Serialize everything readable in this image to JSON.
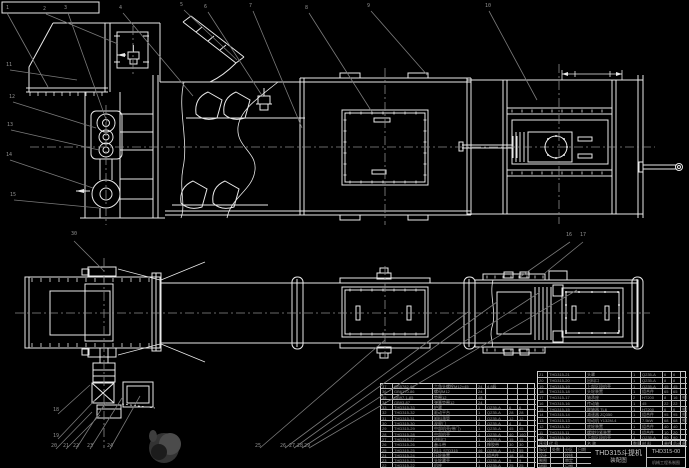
{
  "drawing": {
    "title": "THD315斗提机",
    "subtitle": "装配图",
    "drawing_no": "THD315-00",
    "colors": {
      "background": "#000000",
      "line": "#e9e9e9",
      "leader": "#7a7a7a",
      "table_text": "#9a9a9a"
    }
  },
  "title_block": {
    "product": "THD315斗提机",
    "type": "装配图",
    "no": "THD315-00",
    "org": "机械工程系制图"
  },
  "title_grid": {
    "rows": [
      [
        "标记",
        "处数",
        "分区",
        "日期"
      ],
      [
        "设计",
        "",
        "校核",
        ""
      ],
      [
        "制图",
        "",
        "审定",
        ""
      ],
      [
        "描图",
        "",
        "日期",
        ""
      ]
    ]
  },
  "parts_right_header": {
    "rows": [
      [
        "序号",
        "代  号",
        "名  称",
        "数量",
        "材 料",
        "单件",
        "总计",
        "备注"
      ]
    ]
  },
  "parts_table_right": {
    "rows": [
      [
        "21",
        "THD315-21",
        "头罩",
        "1",
        "Q235-A",
        "6",
        "6",
        ""
      ],
      [
        "20",
        "THD315-20",
        "出料口",
        "1",
        "Q235-A",
        "8",
        "8",
        ""
      ],
      [
        "19",
        "THD315-19",
        "上部区段机壳",
        "1",
        "Q235-A",
        "45",
        "45",
        ""
      ],
      [
        "18",
        "THD315-18",
        "头轮装置",
        "1",
        "组合件",
        "65",
        "65",
        ""
      ],
      [
        "17",
        "THD315-17",
        "轴承座",
        "2",
        "HT200",
        "8",
        "16",
        "外购"
      ],
      [
        "16",
        "THD315-16",
        "传动轴",
        "1",
        "45",
        "22",
        "22",
        ""
      ],
      [
        "15",
        "THD315-15",
        "联轴器 TL6",
        "1",
        "HT200",
        "6",
        "6",
        "外购"
      ],
      [
        "14",
        "THD315-14",
        "减速器 ZQ350",
        "1",
        "组合件",
        "95",
        "95",
        "外购"
      ],
      [
        "13",
        "THD315-13",
        "电动机 Y132M-4",
        "1",
        "7.5kW",
        "68",
        "68",
        "外购"
      ],
      [
        "12",
        "THD315-12",
        "底轮装置",
        "1",
        "组合件",
        "40",
        "40",
        ""
      ],
      [
        "11",
        "THD315-11",
        "螺旋拉紧装置",
        "2",
        "组合件",
        "10",
        "20",
        ""
      ],
      [
        "10",
        "THD315-10",
        "下部区段机壳",
        "1",
        "Q235-A",
        "90",
        "90",
        ""
      ]
    ]
  },
  "parts_table_left": {
    "rows": [
      [
        "37",
        "GB5782-86",
        "六角头螺栓M12×45",
        "24",
        "4.8级",
        "",
        "",
        ""
      ],
      [
        "36",
        "GB6170-86",
        "螺母M12",
        "24",
        "",
        "",
        "",
        ""
      ],
      [
        "35",
        "GB97.1-85",
        "垫圈12",
        "48",
        "",
        "",
        "",
        ""
      ],
      [
        "34",
        "GB93-87",
        "弹簧垫圈12",
        "24",
        "",
        "",
        "",
        ""
      ],
      [
        "33",
        "THD315-33",
        "护罩",
        "1",
        "Q235-A",
        "6",
        "6",
        ""
      ],
      [
        "32",
        "THD315-32",
        "驱动平台",
        "1",
        "Q235-A",
        "28",
        "28",
        ""
      ],
      [
        "31",
        "THD315-31",
        "卸料溜管",
        "1",
        "Q235-A",
        "12",
        "12",
        ""
      ],
      [
        "30",
        "THD315-30",
        "观察门",
        "2",
        "Q235-A",
        "4",
        "8",
        ""
      ],
      [
        "29",
        "THD315-29",
        "中部机壳(带门)",
        "1",
        "Q235-A",
        "45",
        "45",
        ""
      ],
      [
        "28",
        "THD315-28",
        "中部机壳",
        "4",
        "Q235-A",
        "40",
        "160",
        ""
      ],
      [
        "27",
        "THD315-27",
        "进料口",
        "1",
        "Q235-A",
        "15",
        "15",
        ""
      ],
      [
        "26",
        "THD315-26",
        "畚斗带",
        "1",
        "橡胶带",
        "30",
        "30",
        ""
      ],
      [
        "25",
        "THD315-25",
        "料斗 STD315",
        "46",
        "Q235-A",
        "1.2",
        "55",
        ""
      ],
      [
        "24",
        "THD315-24",
        "压轮装置",
        "1",
        "组合件",
        "18",
        "18",
        ""
      ],
      [
        "23",
        "THD315-23",
        "头轮罩壳",
        "1",
        "Q235-A",
        "9",
        "9",
        ""
      ],
      [
        "22",
        "THD315-22",
        "机座",
        "1",
        "Q235-A",
        "25",
        "25",
        ""
      ]
    ]
  },
  "balloons": [
    {
      "n": "1",
      "x": 6,
      "y": 6
    },
    {
      "n": "2",
      "x": 43,
      "y": 7
    },
    {
      "n": "3",
      "x": 64,
      "y": 6
    },
    {
      "n": "4",
      "x": 119,
      "y": 6
    },
    {
      "n": "5",
      "x": 180,
      "y": 3
    },
    {
      "n": "6",
      "x": 204,
      "y": 5
    },
    {
      "n": "7",
      "x": 249,
      "y": 4
    },
    {
      "n": "8",
      "x": 305,
      "y": 6
    },
    {
      "n": "9",
      "x": 367,
      "y": 4
    },
    {
      "n": "10",
      "x": 485,
      "y": 4
    },
    {
      "n": "11",
      "x": 6,
      "y": 63
    },
    {
      "n": "12",
      "x": 9,
      "y": 95
    },
    {
      "n": "13",
      "x": 7,
      "y": 123
    },
    {
      "n": "14",
      "x": 6,
      "y": 153
    },
    {
      "n": "15",
      "x": 10,
      "y": 193
    },
    {
      "n": "16",
      "x": 566,
      "y": 233
    },
    {
      "n": "17",
      "x": 580,
      "y": 233
    },
    {
      "n": "30",
      "x": 71,
      "y": 232
    },
    {
      "n": "18",
      "x": 53,
      "y": 408
    },
    {
      "n": "19",
      "x": 53,
      "y": 434
    },
    {
      "n": "20",
      "x": 51,
      "y": 444
    },
    {
      "n": "21",
      "x": 63,
      "y": 444
    },
    {
      "n": "22",
      "x": 73,
      "y": 444
    },
    {
      "n": "23",
      "x": 87,
      "y": 444
    },
    {
      "n": "24",
      "x": 107,
      "y": 444
    },
    {
      "n": "25",
      "x": 255,
      "y": 444
    },
    {
      "n": "26",
      "x": 280,
      "y": 444
    },
    {
      "n": "27",
      "x": 289,
      "y": 444
    },
    {
      "n": "28",
      "x": 297,
      "y": 444
    },
    {
      "n": "29",
      "x": 304,
      "y": 444
    }
  ]
}
